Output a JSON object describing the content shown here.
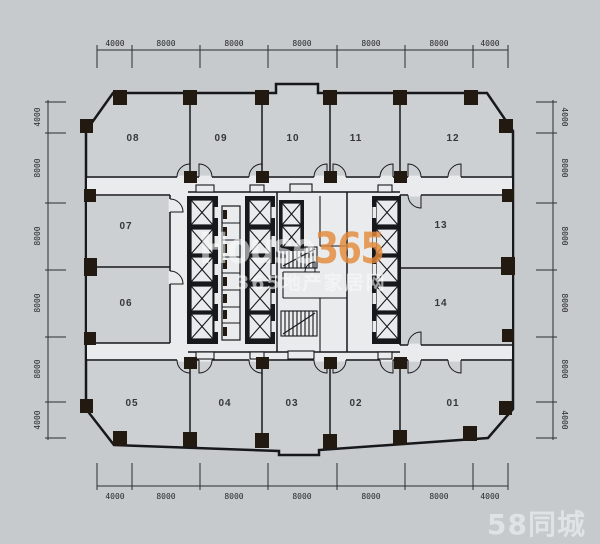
{
  "plan": {
    "rooms": {
      "r01": "01",
      "r02": "02",
      "r03": "03",
      "r04": "04",
      "r05": "05",
      "r06": "06",
      "r07": "07",
      "r08": "08",
      "r09": "09",
      "r10": "10",
      "r11": "11",
      "r12": "12",
      "r13": "13",
      "r14": "14"
    },
    "dimensions": {
      "top": [
        "4000",
        "8000",
        "8000",
        "8000",
        "8000",
        "8000",
        "4000"
      ],
      "bottom": [
        "4000",
        "8000",
        "8000",
        "8000",
        "8000",
        "8000",
        "4000"
      ],
      "left": [
        "4000",
        "8000",
        "8000",
        "8000",
        "8000",
        "4000"
      ],
      "right": [
        "4000",
        "8000",
        "8000",
        "8000",
        "8000",
        "4000"
      ]
    }
  },
  "watermarks": {
    "house365": {
      "prefix": "House",
      "suffix": "365",
      "tagline": "365地产家居网"
    },
    "site_logo": "58同城"
  },
  "colors": {
    "background": "#c6cacd",
    "room_fill": "#ccd0d3",
    "core_fill": "#e9ebec",
    "wall": "#17181c",
    "column": "#221a10",
    "brand_orange": "#e48a3a",
    "watermark_white": "#fbfcfc"
  }
}
